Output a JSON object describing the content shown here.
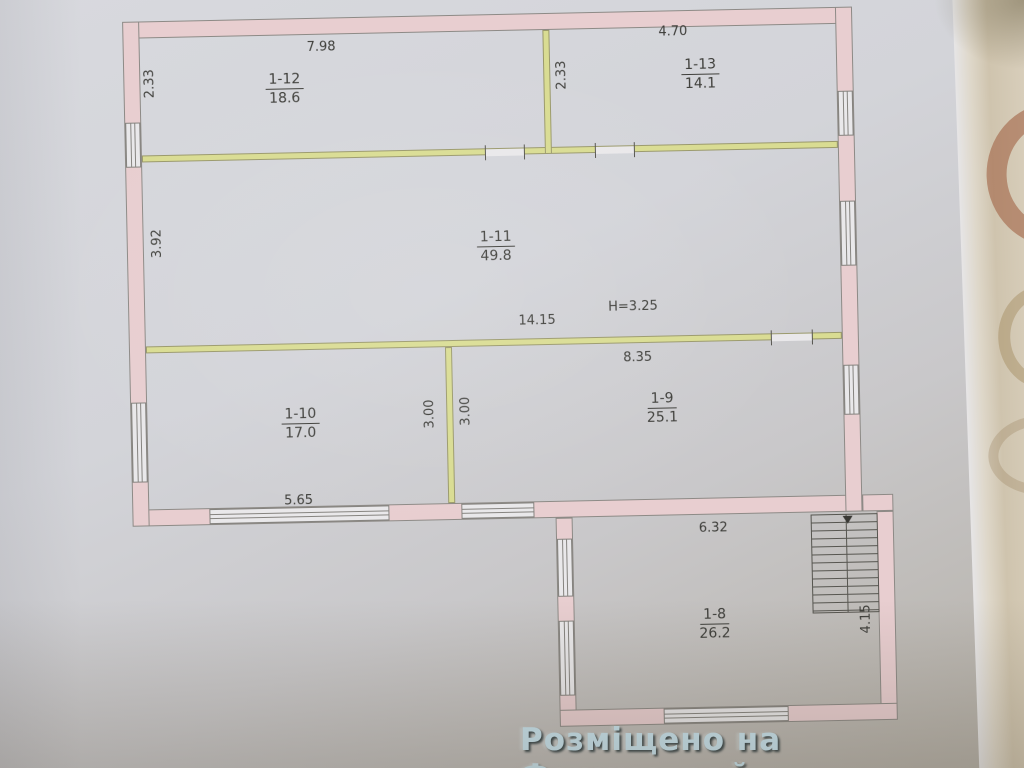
{
  "watermark": "Розміщено на Форумстрой",
  "rooms": {
    "r12": {
      "id": "1-12",
      "area": "18.6"
    },
    "r13": {
      "id": "1-13",
      "area": "14.1"
    },
    "r11": {
      "id": "1-11",
      "area": "49.8"
    },
    "r10": {
      "id": "1-10",
      "area": "17.0"
    },
    "r9": {
      "id": "1-9",
      "area": "25.1"
    },
    "r8": {
      "id": "1-8",
      "area": "26.2"
    }
  },
  "dims": {
    "top_left_width": "7.98",
    "top_right_width": "4.70",
    "top_left_height": "2.33",
    "top_mid_height": "2.33",
    "mid_left_height": "3.92",
    "hall_width": "14.15",
    "ceiling_height": "H=3.25",
    "r9_width": "8.35",
    "r10_height": "3.00",
    "r9_height": "3.00",
    "r10_bottom_width": "5.65",
    "r8_width": "6.32",
    "r8_height": "4.15"
  },
  "colors": {
    "exterior_wall": "#e8ced0",
    "partition": "#d9dc92",
    "ink": "#3e3e3a",
    "watermark": "#c9e4ef"
  }
}
